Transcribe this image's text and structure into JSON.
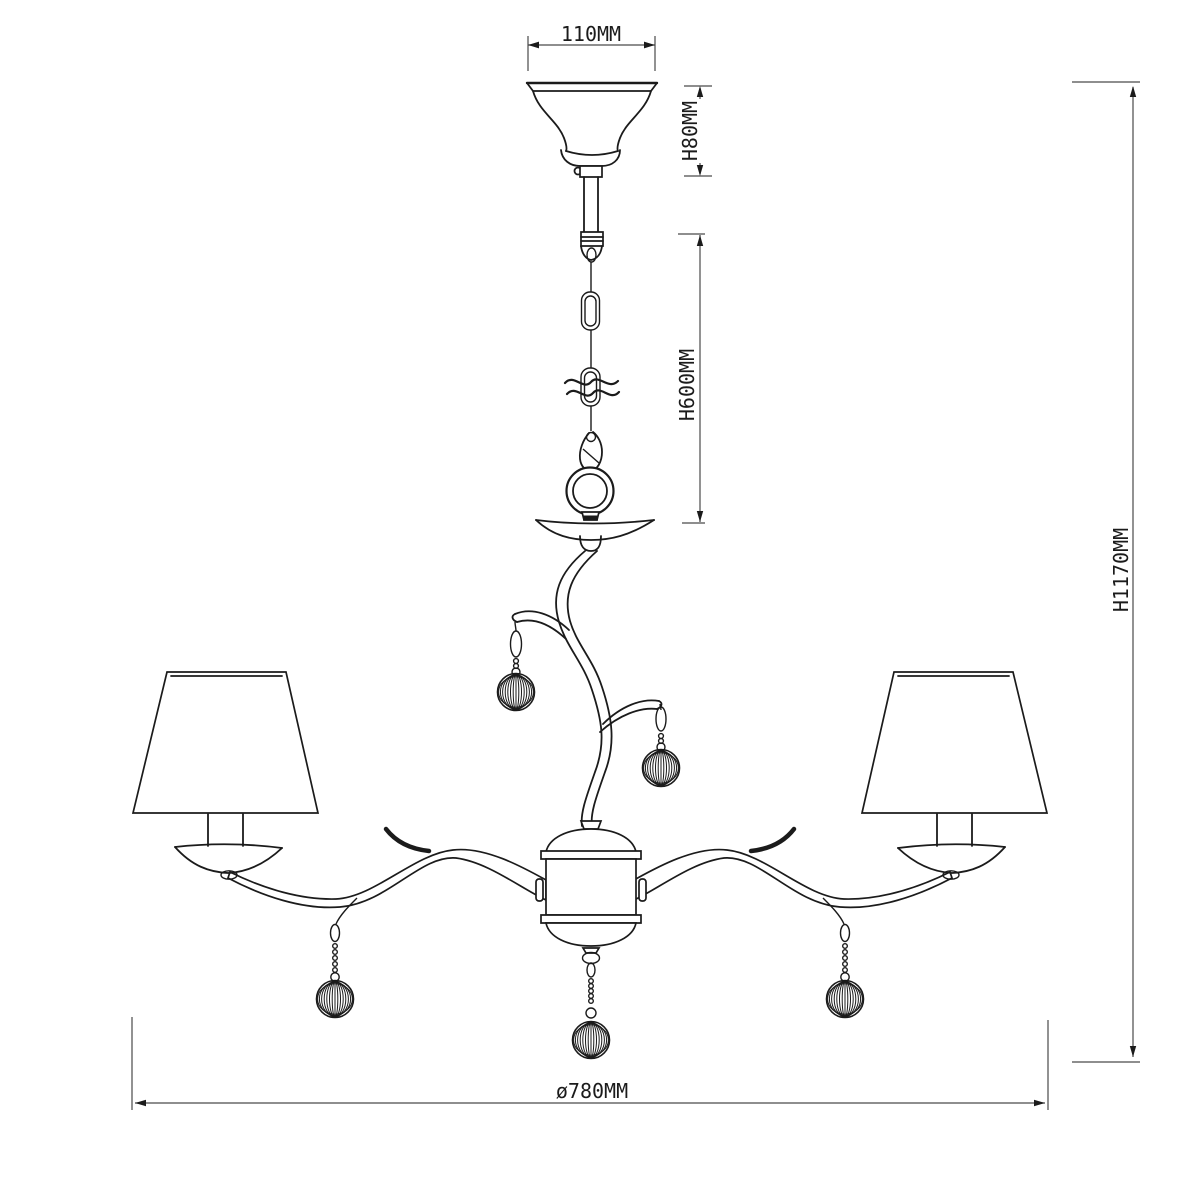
{
  "drawing": {
    "title": "chandelier-dimension-diagram"
  },
  "dimensions": {
    "canopy_width": "110MM",
    "canopy_height": "H80MM",
    "chain_length": "H600MM",
    "total_height": "H1170MM",
    "diameter": "ø780MM"
  },
  "colors": {
    "background": "#ffffff",
    "line": "#1b1b1b",
    "dimension_line": "#4a4a4a"
  }
}
